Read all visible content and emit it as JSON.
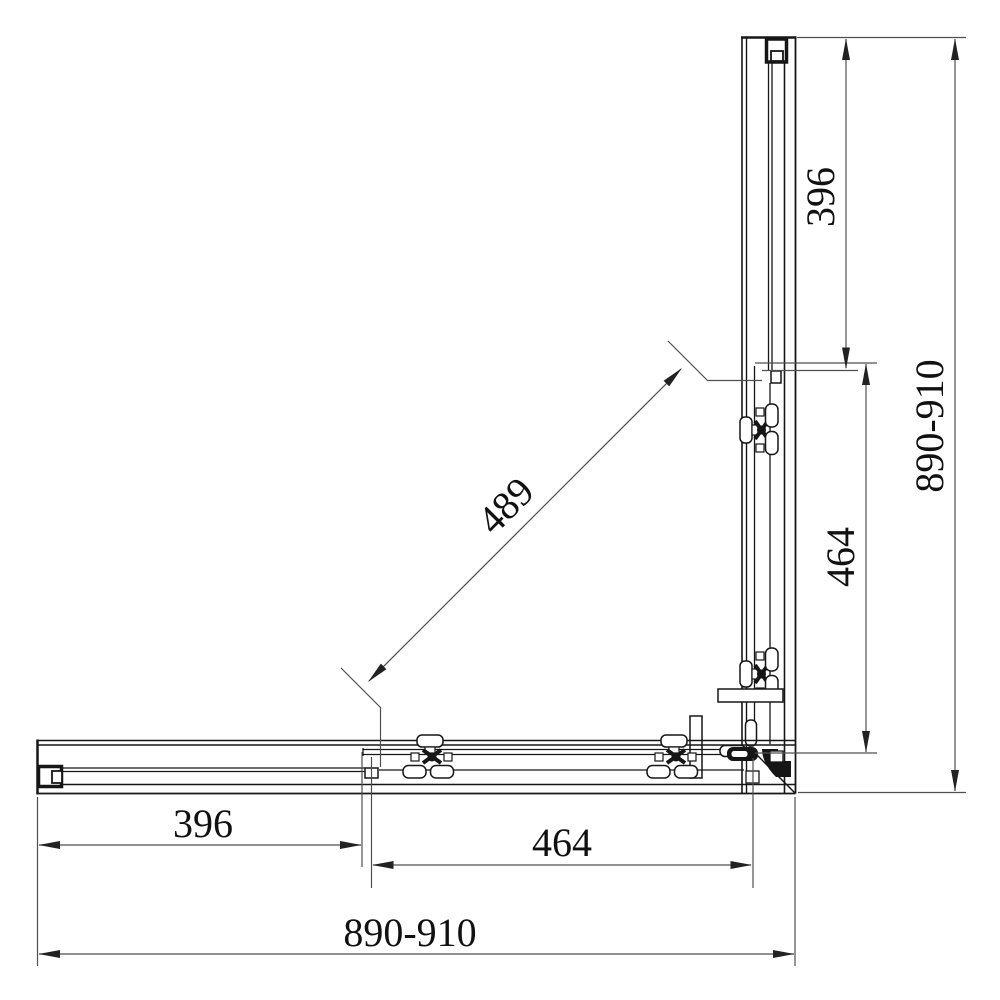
{
  "drawing": {
    "type": "technical-drawing",
    "dimensions": {
      "right_fixed_panel": "396",
      "right_door": "464",
      "right_overall": "890-910",
      "bottom_fixed_panel": "396",
      "bottom_door": "464",
      "bottom_overall": "890-910",
      "diagonal_opening": "489"
    },
    "colors": {
      "object_line": "#161616",
      "dimension_line": "#4f4f4f",
      "background": "#ffffff"
    }
  }
}
